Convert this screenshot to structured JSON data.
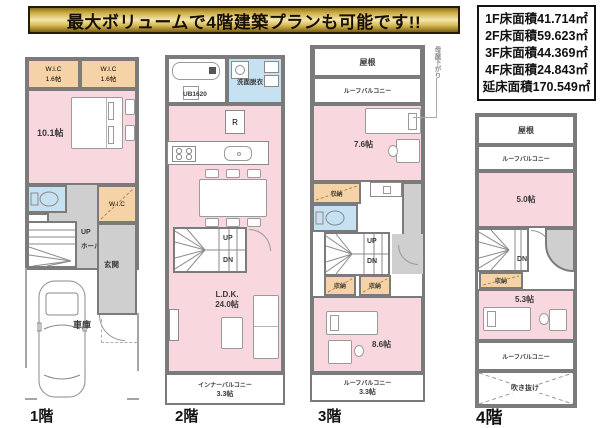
{
  "banner": {
    "text": "最大ボリュームで4階建築プランも可能です!!"
  },
  "area_box": {
    "rows": [
      "1F床面積41.714㎡",
      "2F床面積59.623㎡",
      "3F床面積44.369㎡",
      "4F床面積24.843㎡",
      "延床面積170.549㎡"
    ]
  },
  "colors": {
    "banner_gold": "#d9bb55",
    "room_pink": "#f8d7de",
    "closet_orange": "#f6d3a6",
    "sanitary_blue": "#c6e2f2",
    "wall_gray": "#7b7b7b",
    "hall_gray": "#cfcfcf"
  },
  "floor1": {
    "label": "1階",
    "wic_a": "W.I.C",
    "wic_a_size": "1.6帖",
    "wic_b": "W.I.C",
    "wic_b_size": "1.6帖",
    "bedroom_size": "10.1帖",
    "wic_c": "W.I.C",
    "up": "UP",
    "hall": "ホール",
    "entrance": "玄関",
    "garage": "車庫"
  },
  "floor2": {
    "label": "2階",
    "bath": "UB1620",
    "washroom": "洗面脱衣",
    "fridge": "R",
    "up": "UP",
    "dn": "DN",
    "ldk": "L.D.K.",
    "ldk_size": "24.0帖",
    "balcony": "インナーバルコニー",
    "balcony_size": "3.3帖"
  },
  "floor3": {
    "label": "3階",
    "roof": "屋根",
    "balcony_top": "ルーフバルコニー",
    "room_a_size": "7.6帖",
    "closet_a": "収納",
    "closet_b": "収納",
    "closet_c": "収納",
    "up": "UP",
    "dn": "DN",
    "room_b_size": "8.6帖",
    "balcony_bottom": "ルーフバルコニー",
    "balcony_bottom_size": "3.3帖",
    "note": "母屋下がり"
  },
  "floor4": {
    "label": "4階",
    "roof": "屋根",
    "balcony_top": "ルーフバルコニー",
    "room_a_size": "5.0帖",
    "dn": "DN",
    "closet": "収納",
    "room_b_size": "5.3帖",
    "balcony_bottom": "ルーフバルコニー",
    "void": "吹き抜け"
  }
}
